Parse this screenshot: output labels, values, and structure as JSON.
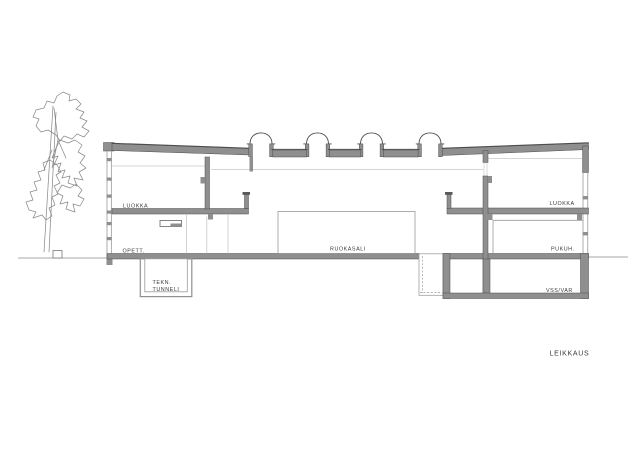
{
  "drawing": {
    "title_label": "LEIKKAUS",
    "rooms": {
      "left_classroom": "LUOKKA",
      "teachers_room": "OPETT.",
      "tech_tunnel_line1": "TEKN.",
      "tech_tunnel_line2": "TUNNELI",
      "dining_hall": "RUOKASALI",
      "right_classroom": "LUOKKA",
      "dressing_room": "PUKUH.",
      "shelter_storage": "VSS/VAR"
    },
    "colors": {
      "wall_fill": "#8f8f8f",
      "line_dark": "#4d4d4d",
      "line_mid": "#8a8a8a",
      "line_light": "#c8c8c8",
      "label_text": "#3a3a3a",
      "background": "#ffffff"
    }
  }
}
